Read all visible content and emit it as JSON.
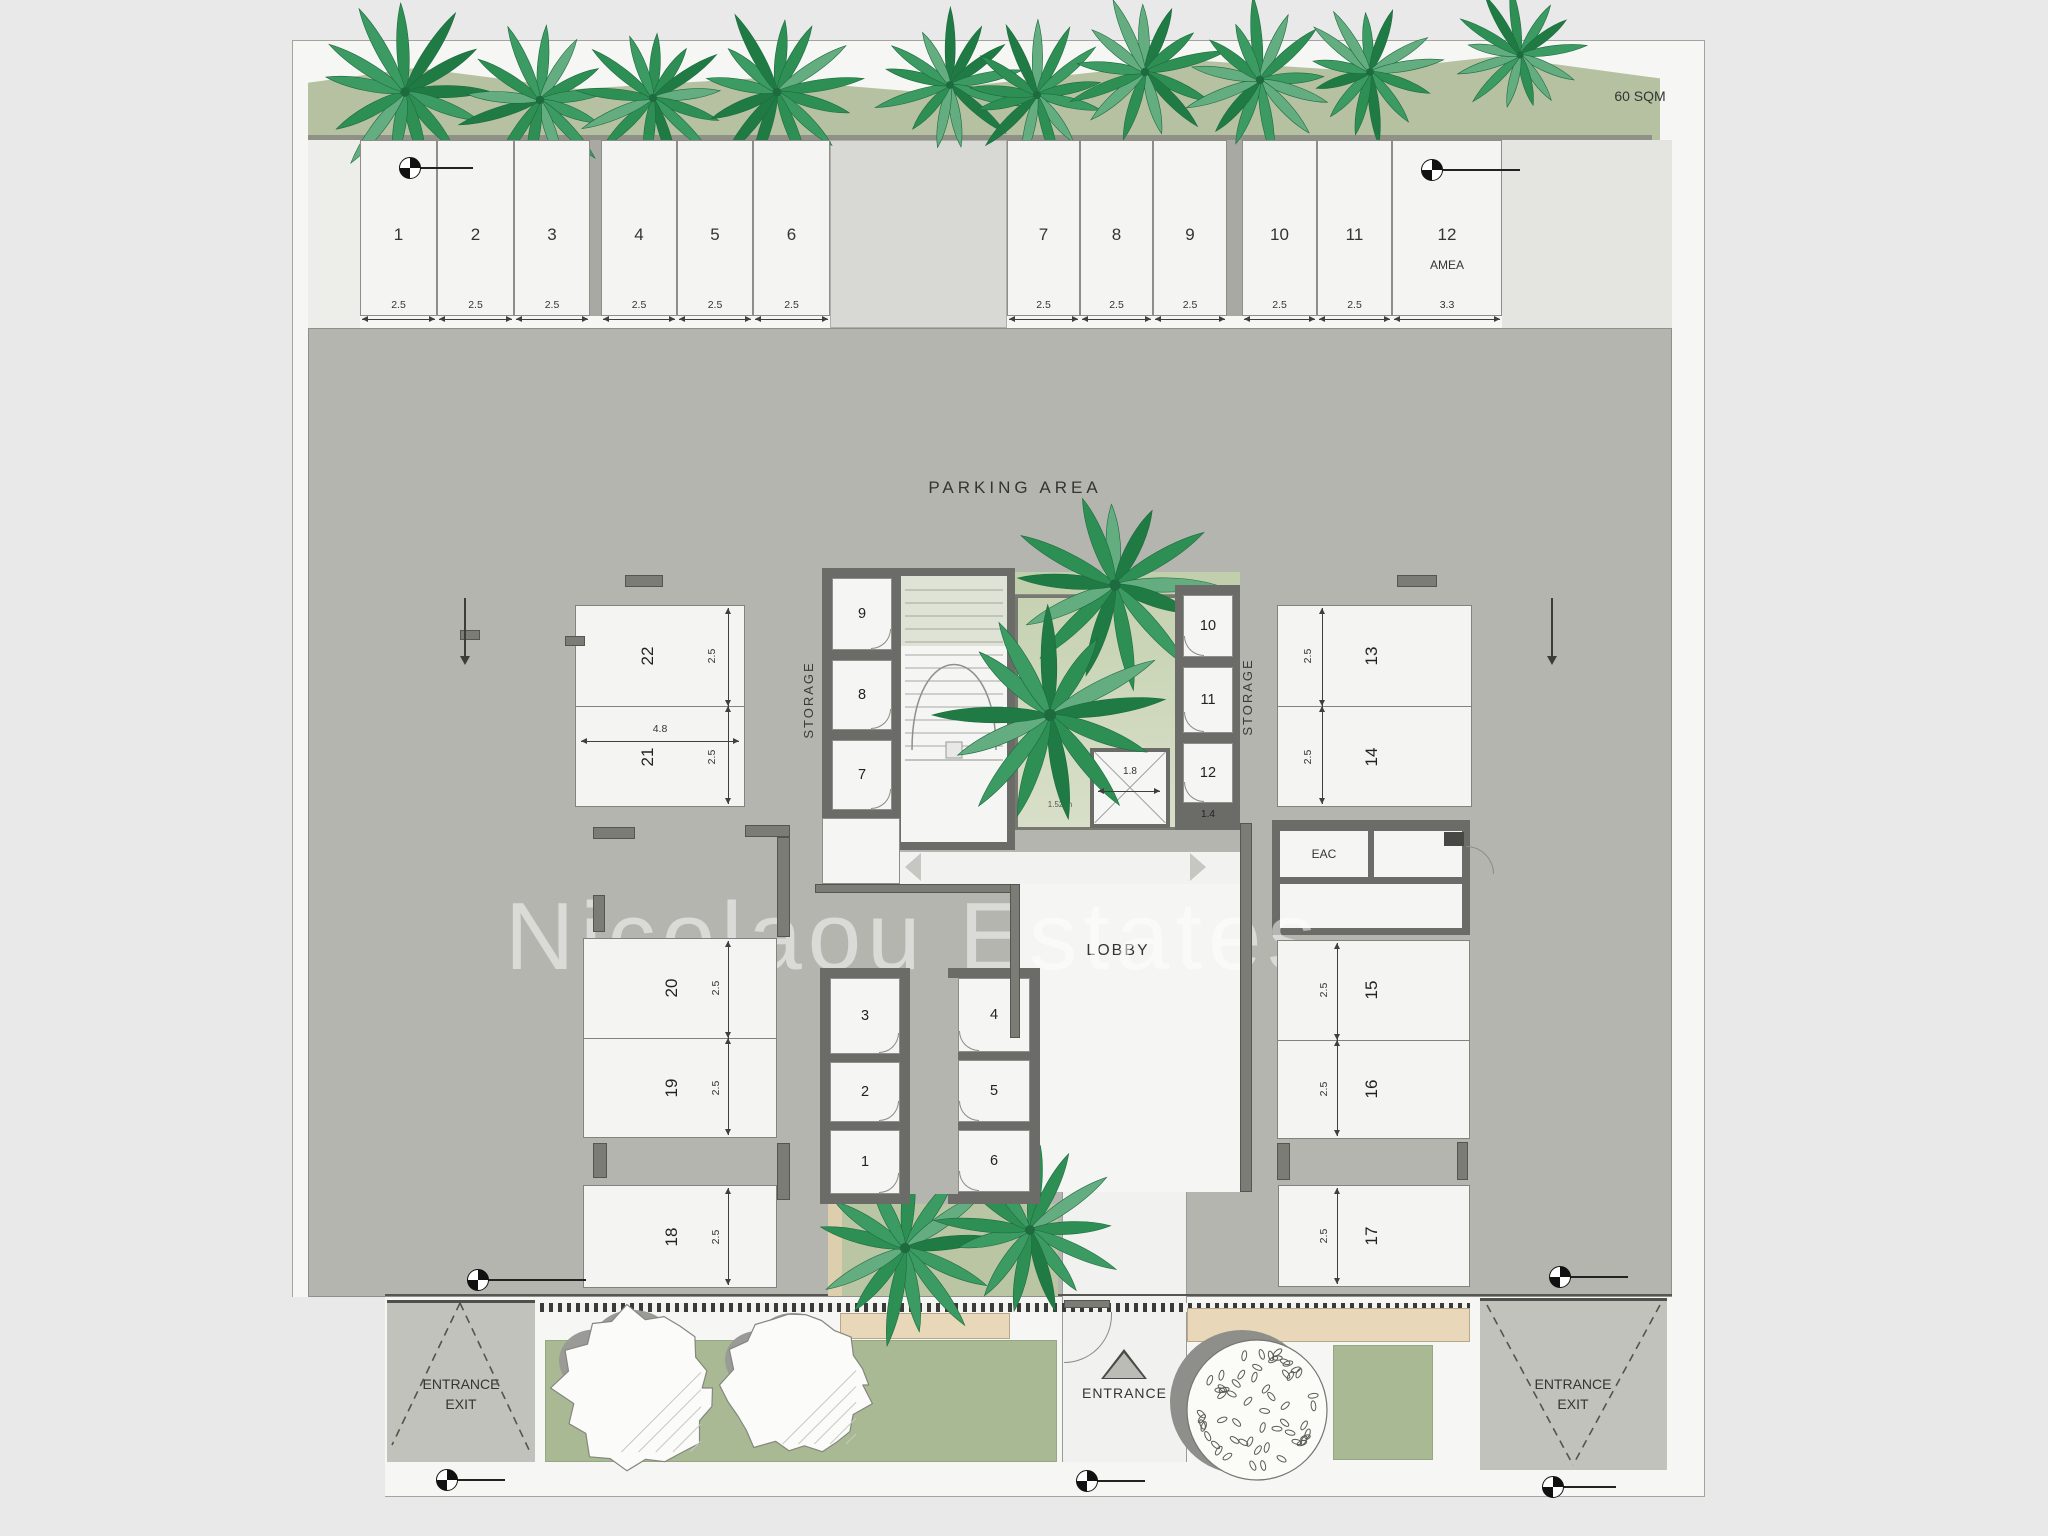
{
  "labels": {
    "sqm": "60 SQM",
    "parking_area": "PARKING AREA",
    "lobby": "LOBBY",
    "eac": "EAC",
    "storage": "STORAGE",
    "entrance": "ENTRANCE",
    "entrance_exit": "ENTRANCE\nEXIT",
    "shaft_dim": "1.52 m",
    "watermark": "Nicolaou Estates"
  },
  "top_stalls": [
    {
      "num": "1",
      "dim": "2.5"
    },
    {
      "num": "2",
      "dim": "2.5"
    },
    {
      "num": "3",
      "dim": "2.5"
    },
    {
      "num": "4",
      "dim": "2.5"
    },
    {
      "num": "5",
      "dim": "2.5"
    },
    {
      "num": "6",
      "dim": "2.5"
    },
    {
      "num": "7",
      "dim": "2.5"
    },
    {
      "num": "8",
      "dim": "2.5"
    },
    {
      "num": "9",
      "dim": "2.5"
    },
    {
      "num": "10",
      "dim": "2.5"
    },
    {
      "num": "11",
      "dim": "2.5"
    },
    {
      "num": "12",
      "dim": "3.3",
      "tag": "AMEA"
    }
  ],
  "parking_blocks": [
    {
      "id": "block-22-21",
      "cells": [
        {
          "num": "22",
          "dim": "2.5"
        },
        {
          "num": "21",
          "dim": "2.5"
        }
      ],
      "width_dim": "4.8"
    },
    {
      "id": "block-20-19",
      "cells": [
        {
          "num": "20",
          "dim": "2.5"
        },
        {
          "num": "19",
          "dim": "2.5"
        }
      ]
    },
    {
      "id": "block-18",
      "cells": [
        {
          "num": "18",
          "dim": "2.5"
        }
      ]
    },
    {
      "id": "block-13-14",
      "cells": [
        {
          "num": "13",
          "dim": "2.5"
        },
        {
          "num": "14",
          "dim": "2.5"
        }
      ]
    },
    {
      "id": "block-15-16",
      "cells": [
        {
          "num": "15",
          "dim": "2.5"
        },
        {
          "num": "16",
          "dim": "2.5"
        }
      ]
    },
    {
      "id": "block-17",
      "cells": [
        {
          "num": "17",
          "dim": "2.5"
        }
      ]
    }
  ],
  "storage_groups": {
    "left": {
      "label": "STORAGE",
      "cells": [
        "9",
        "8",
        "7"
      ]
    },
    "right": {
      "label": "STORAGE",
      "cells": [
        "10",
        "11",
        "12"
      ],
      "last_dim": "1.4"
    },
    "bottom_left": {
      "cells": [
        "3",
        "2",
        "1"
      ]
    },
    "bottom_right": {
      "cells": [
        "4",
        "5",
        "6"
      ]
    },
    "bottom_label": "STORAGE"
  },
  "elevator": {
    "dim": "1.8"
  },
  "colors": {
    "background": "#e9e9ea",
    "paper": "#f6f6f4",
    "asphalt": "#b4b5af",
    "stall": "#f4f4f2",
    "wall": "#6b6c68",
    "green_strip": "#b5c1a0",
    "courtyard": "#ccd6b8",
    "lawn": "#a8b993",
    "garden": "#b9c5a3",
    "tan_paving": "#e8d7b8",
    "entrance_pad": "#c2c2bd",
    "palm": "#2e8f55",
    "dim_text": "#333333"
  }
}
